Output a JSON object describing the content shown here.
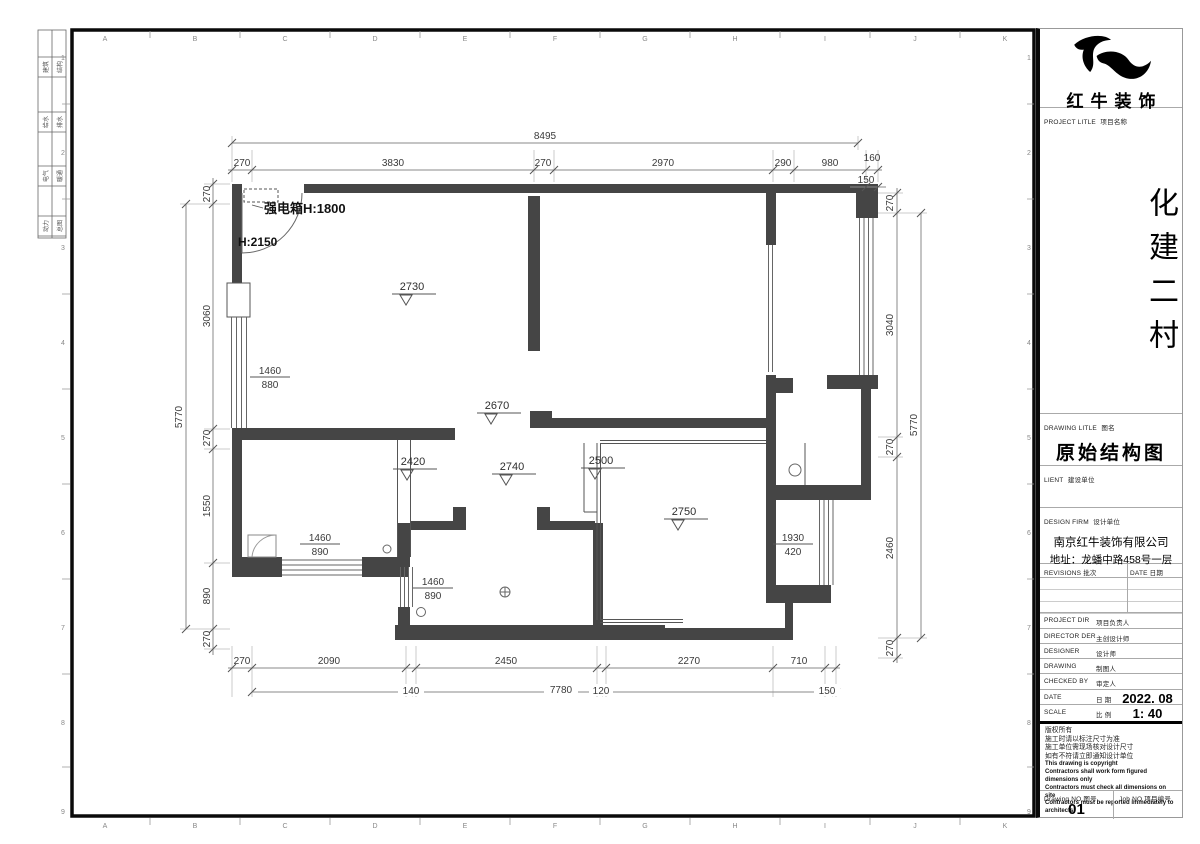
{
  "sheet": {
    "grid_letters": [
      "A",
      "B",
      "C",
      "D",
      "E",
      "F",
      "G",
      "H",
      "I",
      "J",
      "K"
    ],
    "grid_numbers": [
      "1",
      "2",
      "3",
      "4",
      "5",
      "6",
      "7",
      "8",
      "9"
    ],
    "signoff": [
      [
        "建筑",
        "结构"
      ],
      [
        "给水",
        "排水"
      ],
      [
        "电气",
        "暖通"
      ],
      [
        "动力",
        "总图"
      ]
    ]
  },
  "plan": {
    "annotations": {
      "power_box": "强电箱H:1800",
      "door_height": "H:2150"
    },
    "levels": [
      "2730",
      "2670",
      "2420",
      "2740",
      "2500",
      "2750"
    ],
    "windows": [
      [
        "1460",
        "880"
      ],
      [
        "1460",
        "890"
      ],
      [
        "1460",
        "890"
      ],
      [
        "1930",
        "420"
      ]
    ],
    "dims": {
      "top_total": "8495",
      "top": [
        "270",
        "3830",
        "270",
        "2970",
        "290",
        "980",
        "160"
      ],
      "top_right_sub": "150",
      "bottom": [
        "270",
        "2090",
        "2450",
        "2270",
        "710"
      ],
      "bottom2": [
        "140",
        "7780",
        "120",
        "150"
      ],
      "left": [
        "270",
        "3060",
        "270",
        "1550",
        "890",
        "270"
      ],
      "left_total": "5770",
      "right": [
        "270",
        "3040",
        "270",
        "2460",
        "270"
      ],
      "right_total": "5770"
    }
  },
  "titleblock": {
    "brand": "红牛装饰",
    "project_label_en": "PROJECT LITLE",
    "project_label_cn": "项目名称",
    "project_name": "化建二村",
    "drawing_label_en": "DRAWING LITLE",
    "drawing_label_cn": "图名",
    "drawing_title": "原始结构图",
    "client_label_en": "LIENT",
    "client_label_cn": "建设单位",
    "firm_label_en": "DESIGN FIRM",
    "firm_label_cn": "设计单位",
    "firm_name": "南京红牛装饰有限公司",
    "firm_address": "地址：龙蟠中路458号一层",
    "revisions_label_en": "REVISIONS",
    "revisions_label_cn": "批次",
    "date_col_en": "DATE",
    "date_col_cn": "日期",
    "rows": [
      {
        "en": "PROJECT DIR",
        "cn": "项目负责人",
        "value": ""
      },
      {
        "en": "DIRECTOR DER",
        "cn": "主创设计师",
        "value": ""
      },
      {
        "en": "DESIGNER",
        "cn": "设计师",
        "value": ""
      },
      {
        "en": "DRAWING",
        "cn": "制图人",
        "value": ""
      },
      {
        "en": "CHECKED BY",
        "cn": "审定人",
        "value": ""
      },
      {
        "en": "DATE",
        "cn": "日 期",
        "value": "2022. 08"
      },
      {
        "en": "SCALE",
        "cn": "比 例",
        "value": "1: 40"
      }
    ],
    "notes": [
      "版权所有",
      "施工时请以标注尺寸为准",
      "施工单位需现场核对设计尺寸",
      "如有不符请立即通知设计单位",
      "This drawing is copyright",
      "Contractors shall work form figured dimensions only",
      "Contractors must check all dimensions on site",
      "Contractors must be reported immediately to architects"
    ],
    "drawing_no_label_en": "Drawing NO",
    "drawing_no_label_cn": "图号",
    "drawing_no": "01",
    "job_no_label_en": "Job NO",
    "job_no_label_cn": "项目编号"
  }
}
